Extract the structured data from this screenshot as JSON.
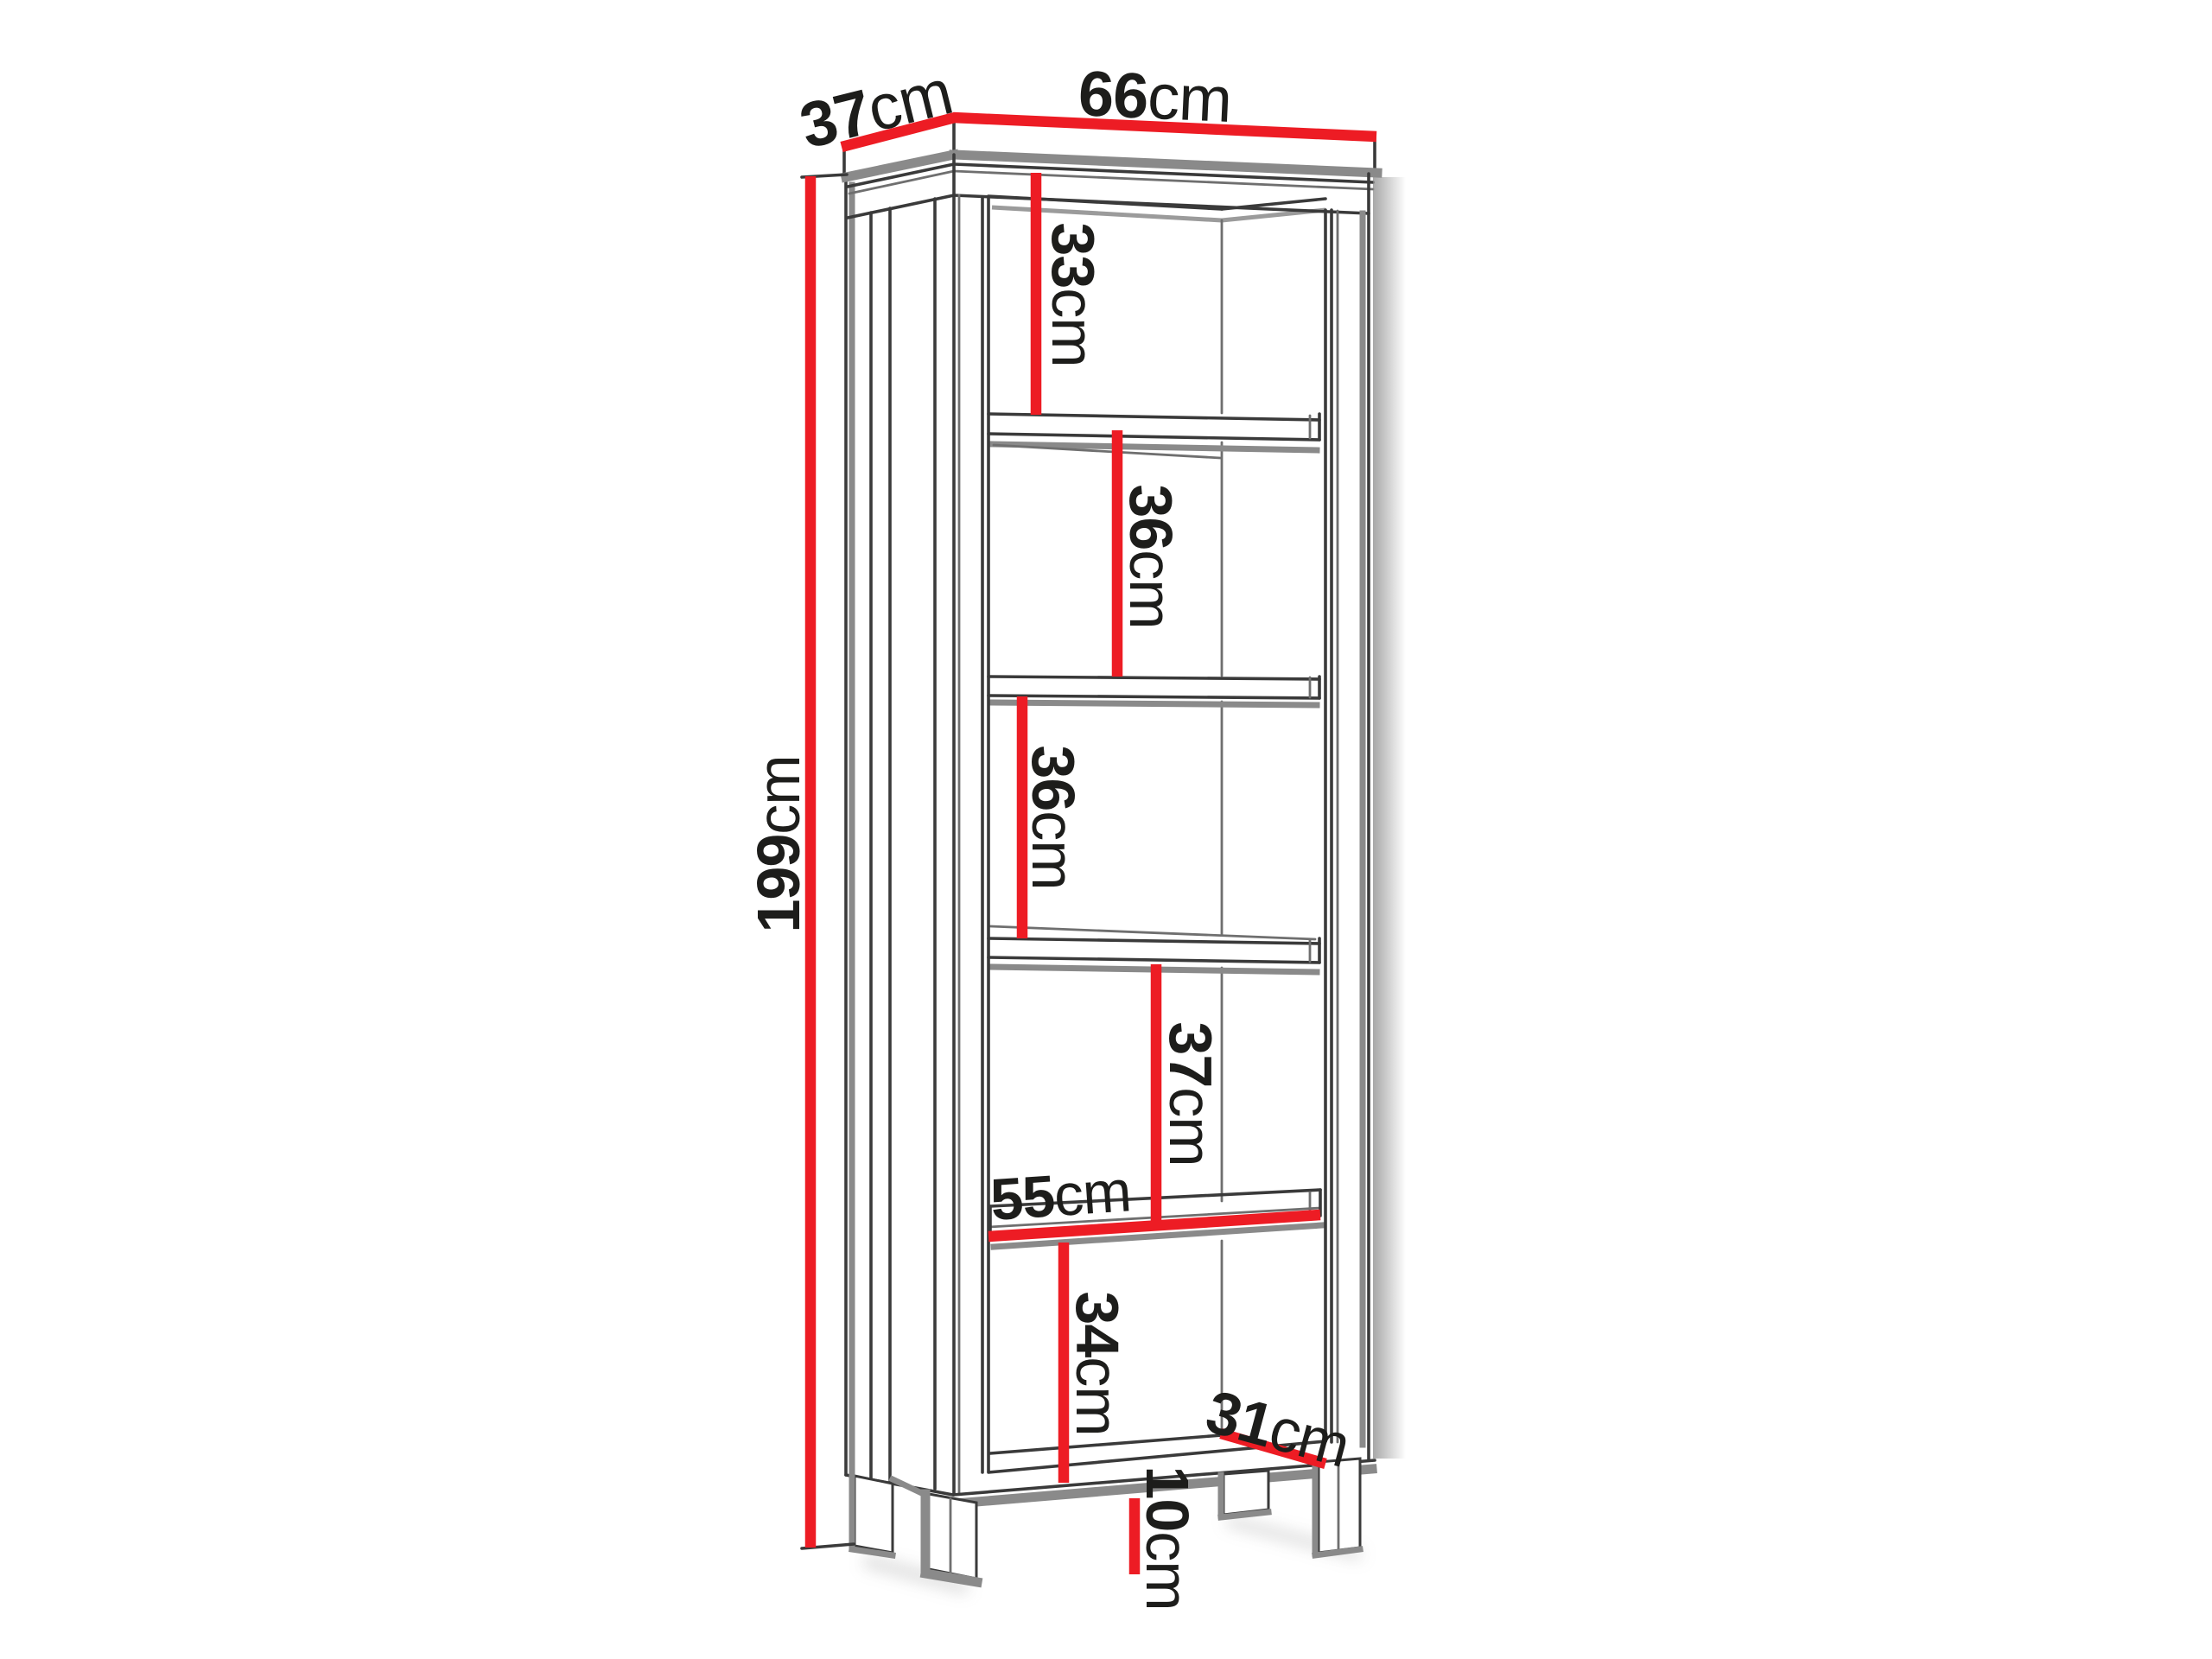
{
  "diagram": {
    "accent_color": "#ed1c24",
    "line_color": "#3a3a3a",
    "shadow_color": "#8a8a8a"
  },
  "dims": {
    "top_depth": {
      "value": "37",
      "unit": "cm"
    },
    "top_width": {
      "value": "66",
      "unit": "cm"
    },
    "height": {
      "value": "199",
      "unit": "cm"
    },
    "compartment_1": {
      "value": "33",
      "unit": "cm"
    },
    "compartment_2": {
      "value": "36",
      "unit": "cm"
    },
    "compartment_3": {
      "value": "36",
      "unit": "cm"
    },
    "compartment_4": {
      "value": "37",
      "unit": "cm"
    },
    "compartment_5": {
      "value": "34",
      "unit": "cm"
    },
    "shelf_width": {
      "value": "55",
      "unit": "cm"
    },
    "base_depth": {
      "value": "31",
      "unit": "cm"
    },
    "leg_height": {
      "value": "10",
      "unit": "cm"
    }
  }
}
